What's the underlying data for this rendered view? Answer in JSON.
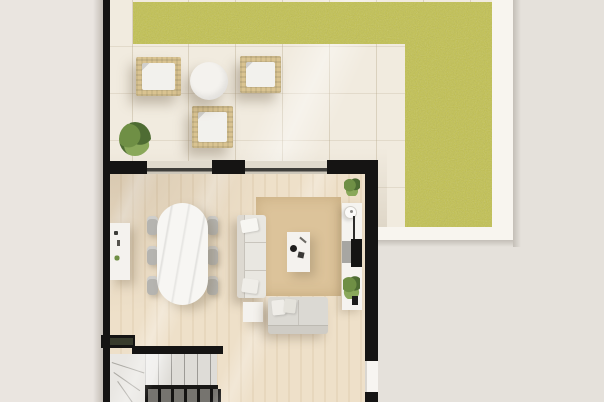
{
  "scene_type": "floor-plan-top-view",
  "colors": {
    "bg": "#e5e1db",
    "bg_left": "#eae5e0",
    "wall": "#151413",
    "grass": "#c3c24f",
    "terrace": "#f1ebdf",
    "deck": "#f8f5ef",
    "floor": "#eee0c9",
    "floor_stripe": "#e7d7bd",
    "rug": "#dcc39a",
    "white_top": "#f4f2ee",
    "sofa": "#e9e7e1",
    "sofa2": "#dbd9d3",
    "chair": "#b5b4b0",
    "wicker": "#d9c391",
    "cushion": "#f2f1ed",
    "plant_dark": "#4e6c33",
    "plant_mid": "#6f8f45",
    "plant_light": "#8aa85a",
    "stair_upper": "#dedcd7",
    "stair_lower": "#76746f",
    "tv": "#141413",
    "panel": "#a7a6a2",
    "glass": "#3f3e3a",
    "door": "#f7f5f1"
  },
  "objects": {
    "outdoor": [
      "grass-lawn",
      "terrace-deck",
      "wicker-armchair-left",
      "wicker-armchair-right",
      "wicker-armchair-bottom",
      "outdoor-round-table",
      "terrace-plant"
    ],
    "living_dining": [
      "sideboard",
      "dining-table",
      "dining-chairs-x6",
      "area-rug",
      "long-sofa",
      "short-sofa",
      "coffee-table-with-decor",
      "side-table",
      "media-wall-unit",
      "tv",
      "wall-lamp",
      "media-plant",
      "corner-plant"
    ],
    "structure": [
      "left-wall",
      "top-wall",
      "right-wall",
      "window-1",
      "window-2",
      "door",
      "staircase",
      "stair-railing"
    ]
  }
}
